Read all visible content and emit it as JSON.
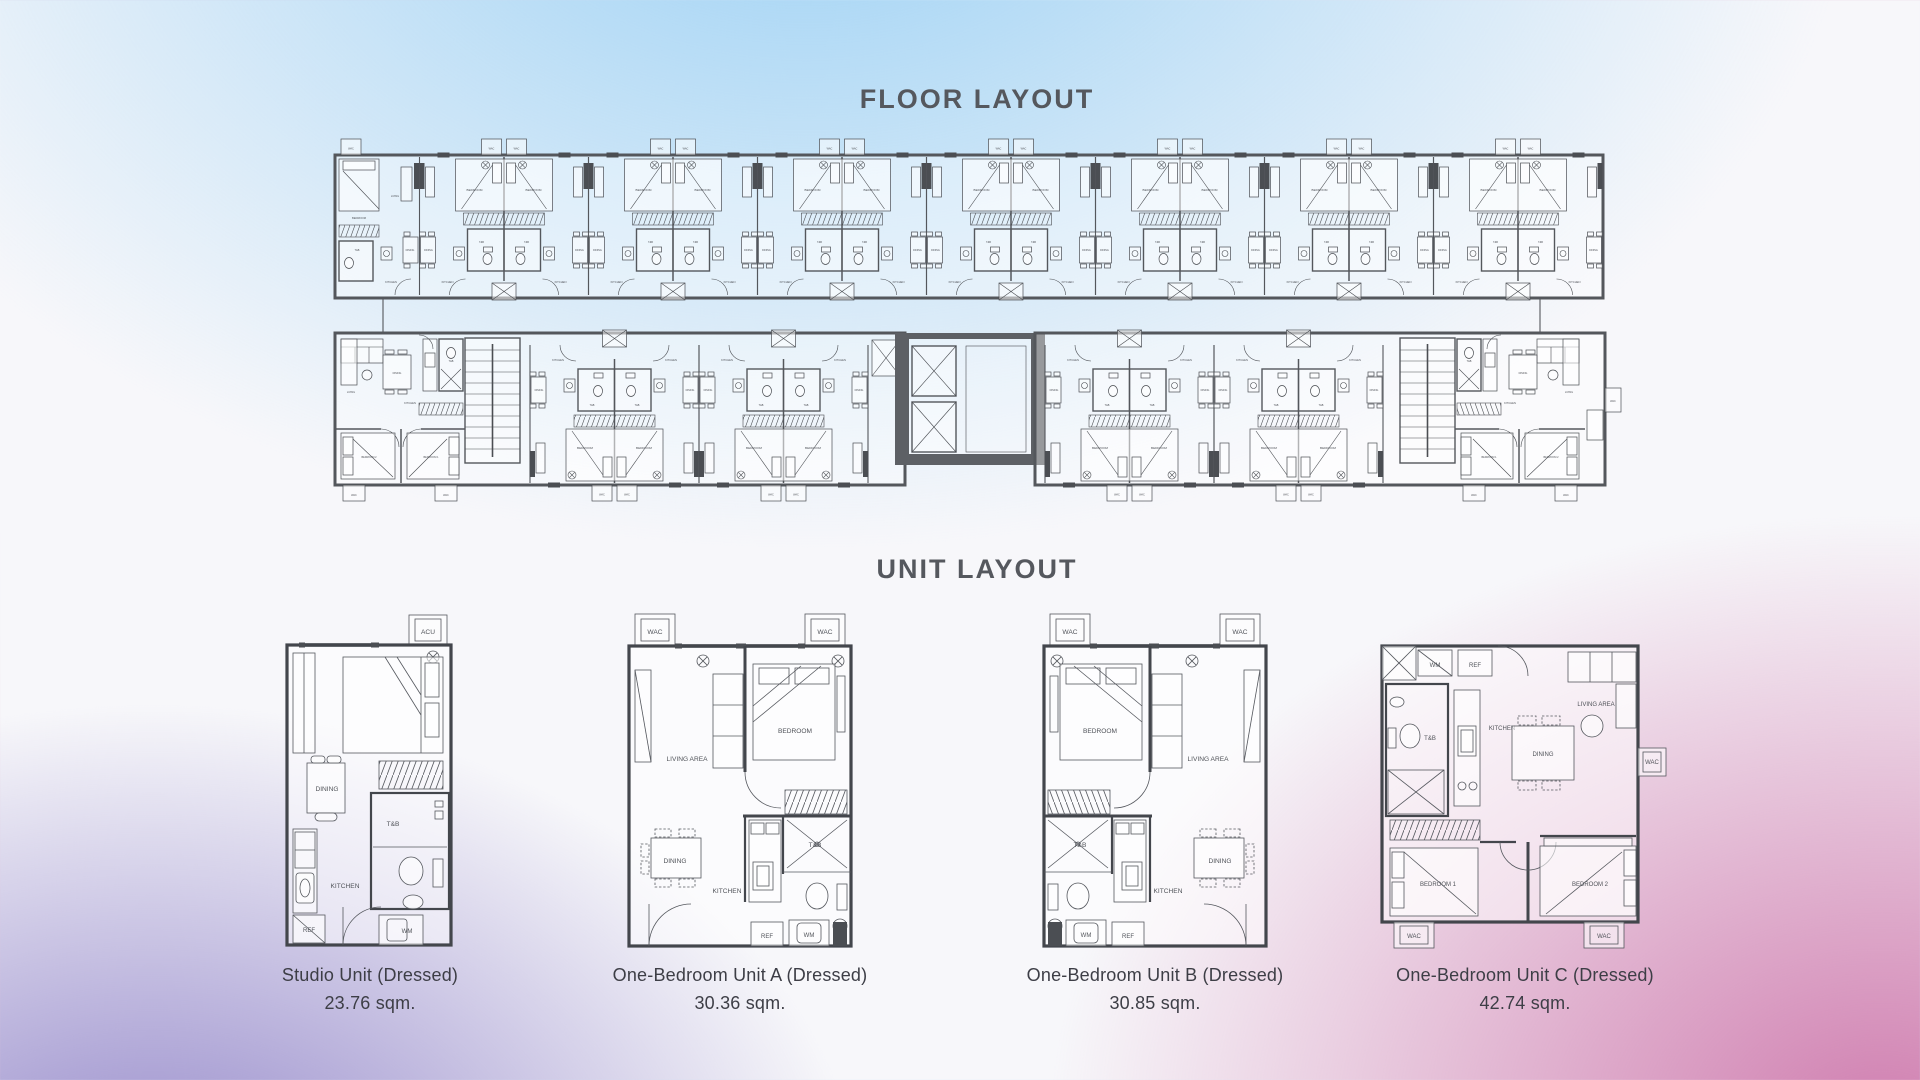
{
  "page": {
    "floor_title": "FLOOR LAYOUT",
    "unit_title": "UNIT LAYOUT"
  },
  "units": [
    {
      "name": "Studio Unit (Dressed)",
      "area": "23.76 sqm."
    },
    {
      "name": "One-Bedroom Unit A (Dressed)",
      "area": "30.36 sqm."
    },
    {
      "name": "One-Bedroom Unit B (Dressed)",
      "area": "30.85 sqm."
    },
    {
      "name": "One-Bedroom Unit C (Dressed)",
      "area": "42.74 sqm."
    }
  ],
  "rooms": {
    "bedroom": "BEDROOM",
    "bedroom1": "BEDROOM 1",
    "bedroom2": "BEDROOM 2",
    "living": "LIVING",
    "living_area": "LIVING AREA",
    "dining": "DINING",
    "kitchen": "KITCHEN",
    "tb": "T&B",
    "wac": "WAC",
    "acu": "ACU",
    "ref": "REF",
    "wm": "WM"
  },
  "colors": {
    "background_blue": "#9cd1f4",
    "background_purple": "#8f82c7",
    "background_pink": "#d07fb0",
    "wall_gray": "#54575c",
    "line_gray": "#4b4e53",
    "title_text": "#55585e",
    "caption_text": "#3d3e46"
  }
}
